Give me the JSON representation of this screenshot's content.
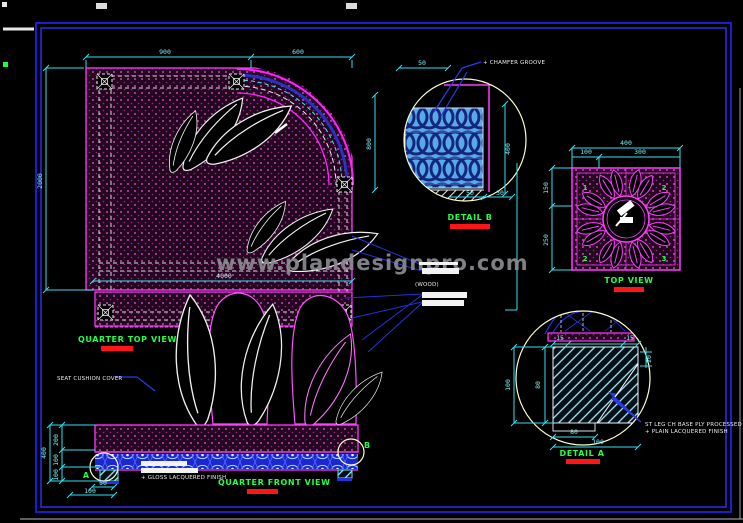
{
  "watermark": "www.plandesignpro.com",
  "labels": {
    "quarter_top_view": "QUARTER TOP VIEW",
    "quarter_front_view": "QUARTER FRONT VIEW",
    "top_view": "TOP VIEW",
    "detail_a": "DETAIL A",
    "detail_b": "DETAIL B"
  },
  "notes": {
    "seat_cushion": "SEAT CUSHION COVER",
    "front_finish": "+ GLOSS LACQUERED FINISH",
    "wood": "(WOOD)",
    "detail_b_note": "+ CHAMFER GROOVE",
    "detail_a_note_1": "ST LEG CH BASE PLY PROCESSED",
    "detail_a_note_2": "+ PLAIN LACQUERED FINISH"
  },
  "markers": {
    "a": "A",
    "b": "B"
  },
  "quarter_top_view": {
    "dim_top_1": "900",
    "dim_top_2": "600",
    "dim_side": "2000",
    "dim_width": "4000"
  },
  "quarter_front_view": {
    "dim_seat": "200",
    "dim_band": "100",
    "dim_leg": "100",
    "dim_total": "400",
    "dim_leg_w": "50",
    "dim_leg_off": "100"
  },
  "top_view": {
    "quadrant_1": "1",
    "quadrant_2": "2",
    "quadrant_3": "2",
    "quadrant_4": "3",
    "dim_total": "400",
    "dim_left": "100",
    "dim_right": "300",
    "dim_side_top": "150",
    "dim_side_bottom": "250"
  },
  "detail_b": {
    "dim_left": "800",
    "dim_right": "400",
    "dim_top": "50",
    "dim_bottom_1": "50",
    "dim_bottom_2": "30"
  },
  "detail_a": {
    "dim_left": "100",
    "dim_inner": "80",
    "dim_top_1": "15",
    "dim_top_2": "15",
    "dim_right": "20",
    "dim_bottom_1": "80",
    "dim_bottom_2": "100"
  },
  "colors": {
    "background": "#000000",
    "line_magenta": "#ff3aff",
    "dim_cyan": "#7deef8",
    "label_green": "#21ff4a",
    "underline_red": "#ff1515",
    "leader_blue": "#2a3ae8",
    "border_blue": "#1c1cd0",
    "watermark_gray": "#8a8a92",
    "detail_circle_yellow": "#ffffca",
    "fabric_blue": "#57aae8"
  }
}
